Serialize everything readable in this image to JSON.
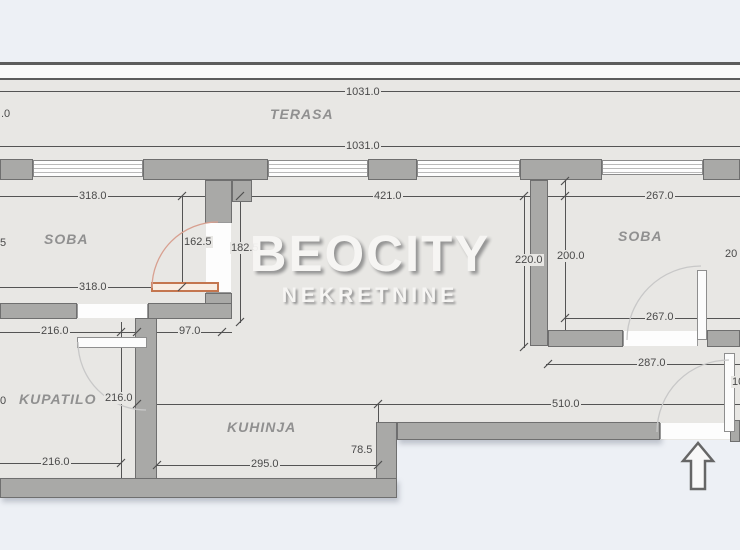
{
  "watermark": {
    "title": "BEOCITY",
    "subtitle": "NEKRETNINE"
  },
  "rooms": {
    "terasa": "TERASA",
    "soba_left": "SOBA",
    "soba_right": "SOBA",
    "kupatilo": "KUPATILO",
    "kuhinja": "KUHINJA"
  },
  "dimensions": {
    "terrace_width_top": "1031.0",
    "terrace_width_bottom": "1031.0",
    "soba_left_width_top": "318.0",
    "soba_left_width_bottom": "318.0",
    "soba_left_depth": "162.5",
    "living_depth": "182.5",
    "living_width": "421.0",
    "living_height_right": "220.0",
    "soba_right_height_left": "200.0",
    "soba_right_width_top": "267.0",
    "soba_right_width_bottom": "267.0",
    "hall_width": "287.0",
    "open_area_width": "510.0",
    "kitchen_recess_depth": "78.5",
    "kitchen_width": "295.0",
    "kupatilo_width_top": "216.0",
    "hall_passage_width": "97.0",
    "kupatilo_depth": "216.0",
    "kupatilo_width_bottom": "216.0",
    "partial_left_top": ".0",
    "partial_left_mid": "5",
    "partial_left_bottom": "0",
    "partial_right_top": "20",
    "partial_right_mid": "10"
  }
}
